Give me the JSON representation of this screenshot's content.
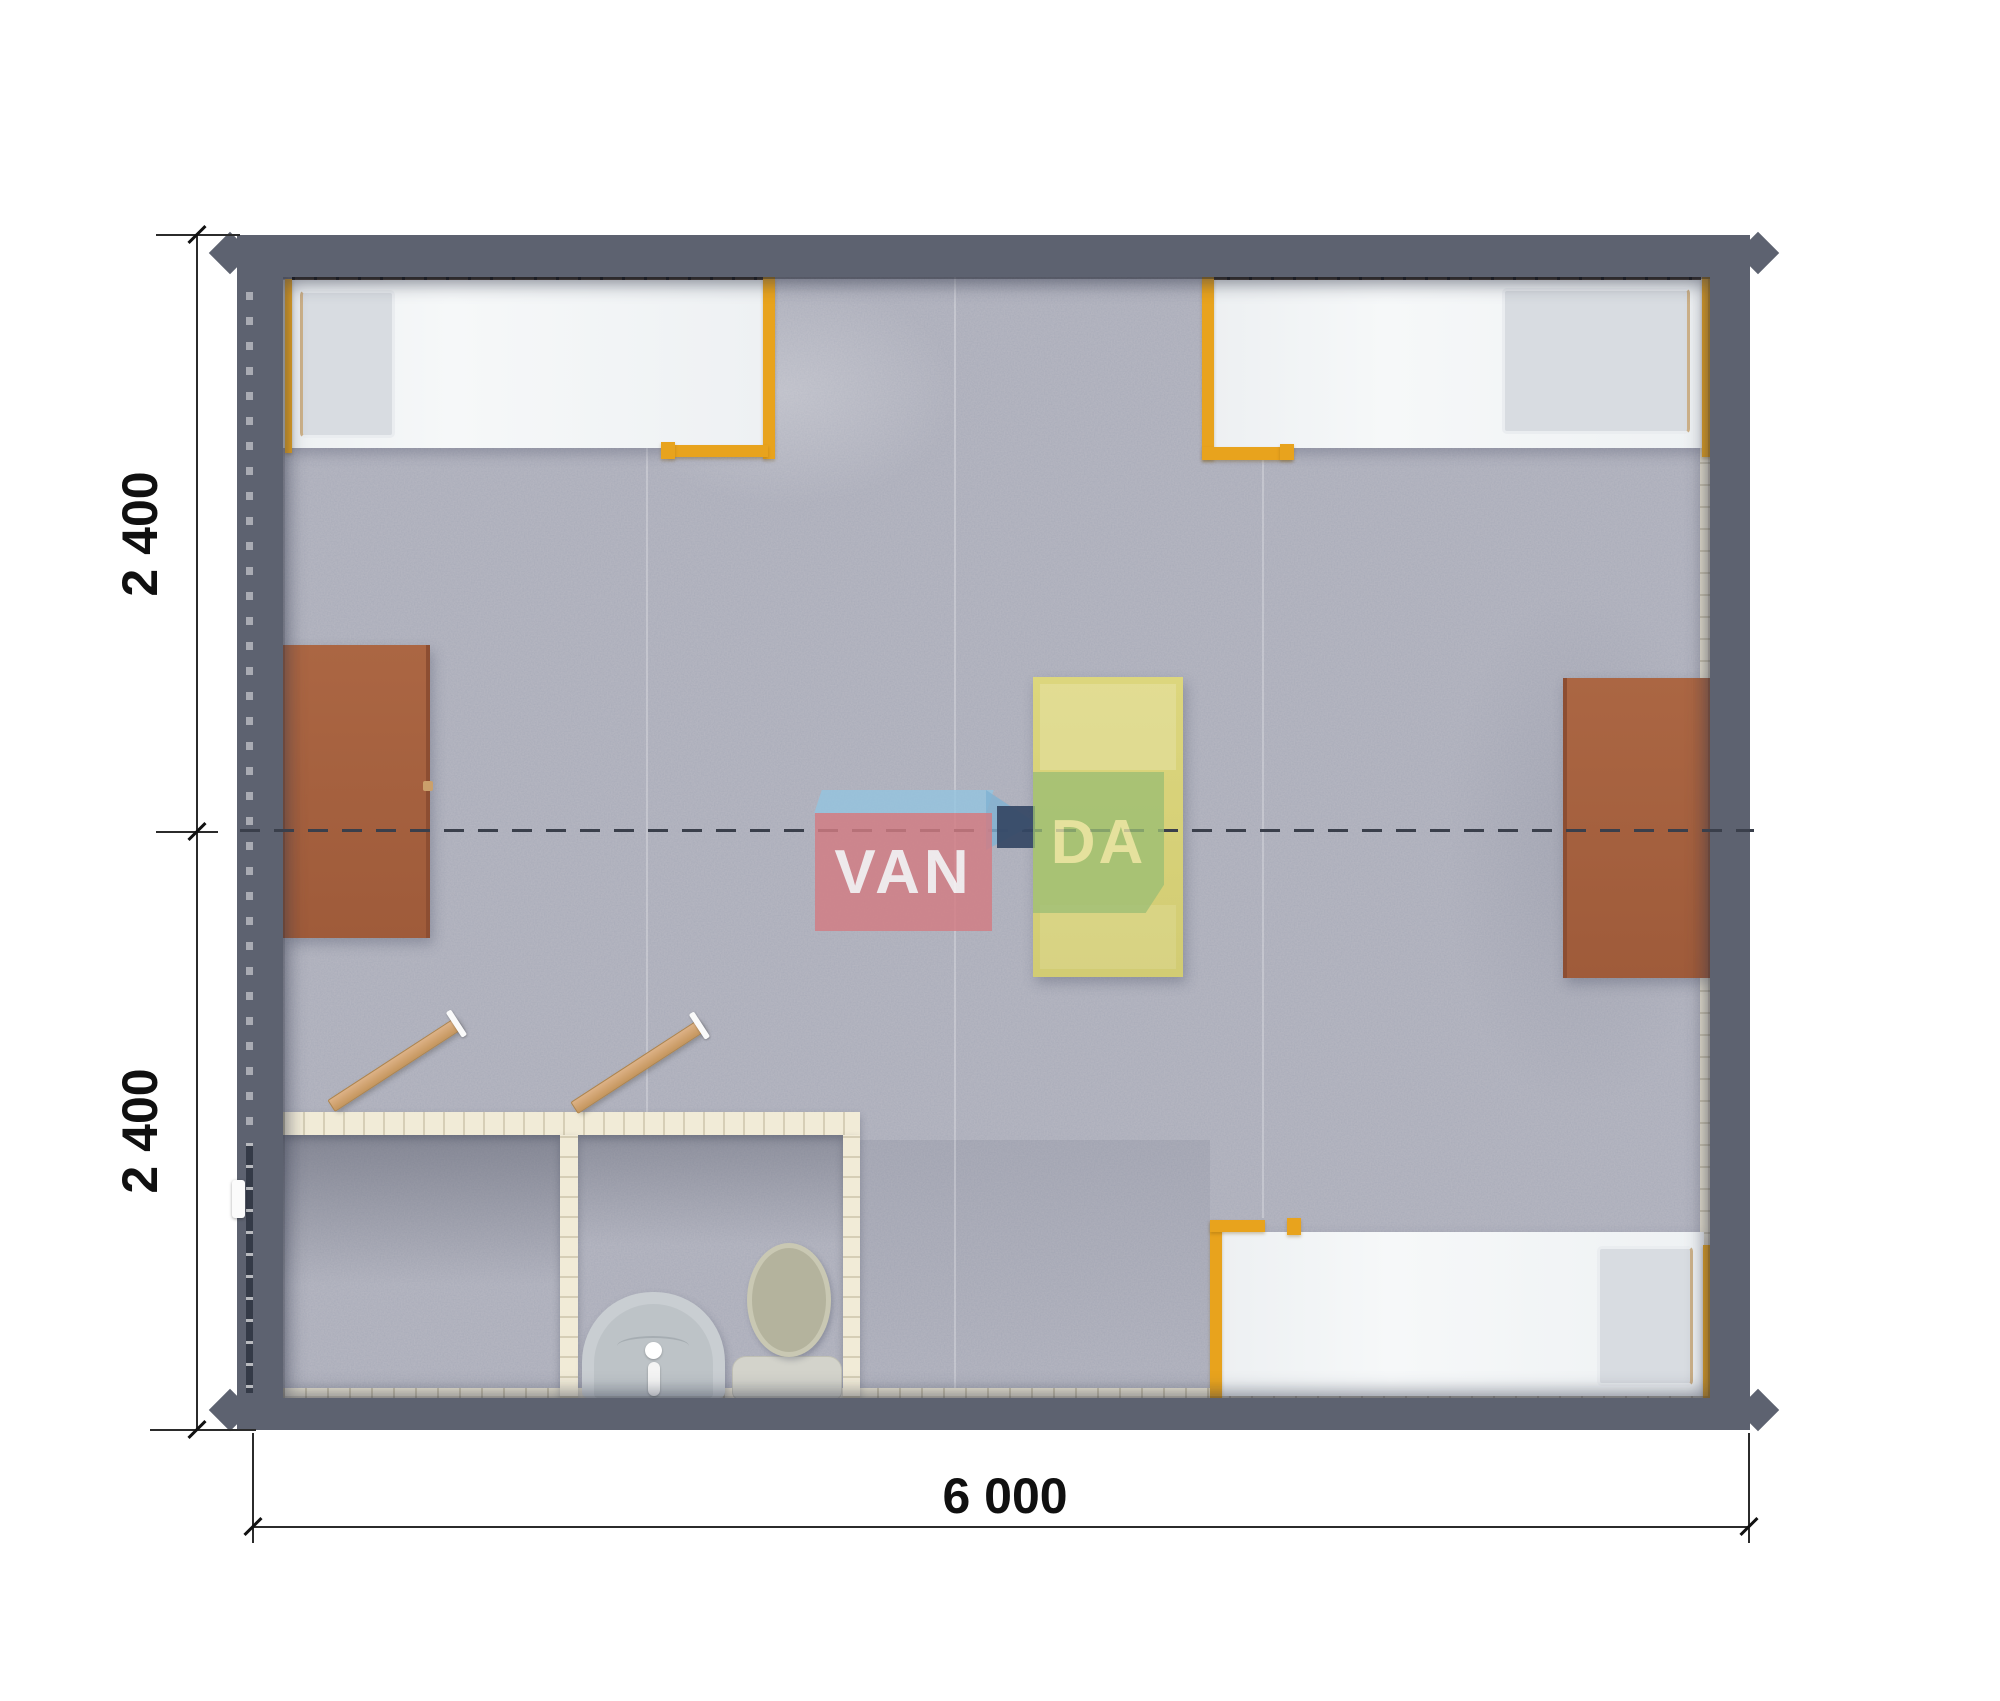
{
  "page": {
    "background": "#ffffff"
  },
  "watermark": {
    "van": "VAN",
    "da": "DA"
  },
  "dimensions": {
    "module_top": "2 400",
    "module_bottom": "2 400",
    "total_width": "6 000"
  },
  "colors": {
    "page_bg": "#ffffff",
    "wall": "#5d6270",
    "carpet": "#b4b5c0",
    "liner": "#ece6d3",
    "partition": "#f1ebd7",
    "accent_orange": "#e8a31d",
    "bed_white": "#f3f5f7",
    "pillow_gray": "#d8dce1",
    "table_brown": "#9f5b3a",
    "table_yellow": "#d2cc73",
    "door_tan": "#c5965e",
    "toilet_seat": "#b4b39d",
    "sink_gray": "#c9ced2",
    "logo_red": "#d37c83",
    "logo_green": "#9cbe74",
    "logo_blue": "#93c4e0",
    "logo_navy": "#344664",
    "dashed_line": "#3a3f4b",
    "dimension_text": "#101010"
  }
}
